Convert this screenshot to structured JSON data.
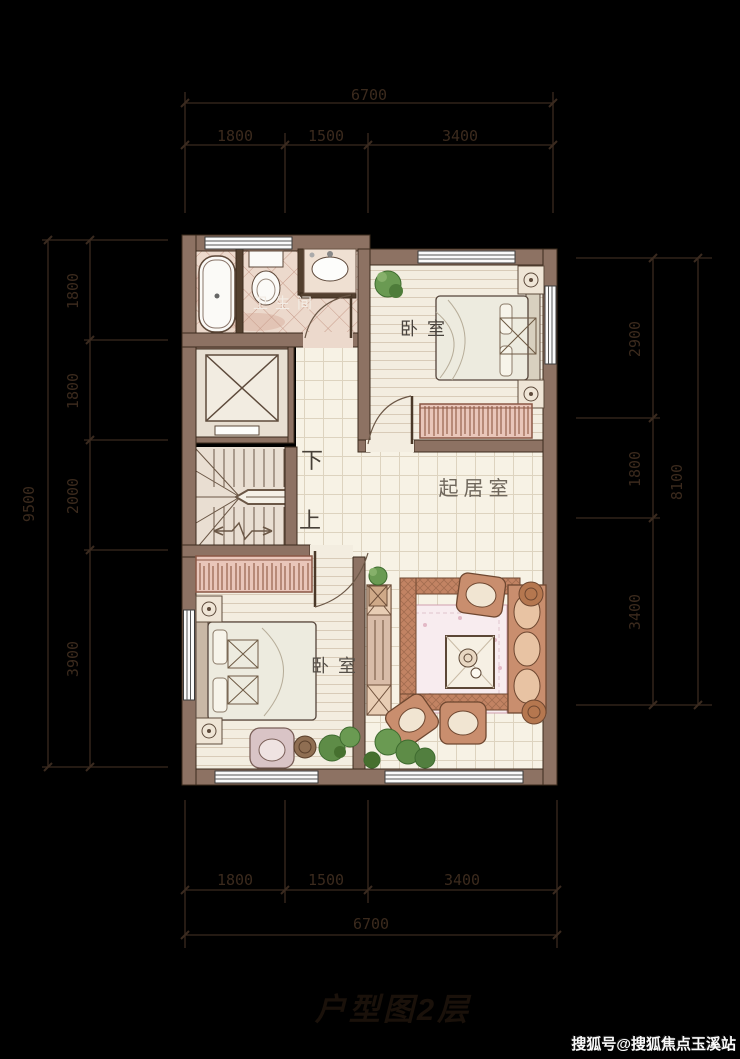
{
  "title": {
    "caption": "户型图2层"
  },
  "watermark": {
    "text": "搜狐号@搜狐焦点玉溪站"
  },
  "rooms": {
    "bathroom": "卫生间",
    "bedroom_top": "卧室",
    "bedroom_bottom": "卧室",
    "living": "起居室",
    "stair_down": "下",
    "stair_up": "上"
  },
  "dimensions": {
    "top": {
      "total": "6700",
      "segments": [
        "1800",
        "1500",
        "3400"
      ]
    },
    "bottom": {
      "total": "6700",
      "segments": [
        "1800",
        "1500",
        "3400"
      ]
    },
    "left": {
      "total": "9500",
      "segments": [
        "1800",
        "1800",
        "2000",
        "3900"
      ]
    },
    "right": {
      "total": "8100",
      "segments": [
        "2900",
        "1800",
        "3400"
      ]
    }
  },
  "colors": {
    "background": "#000000",
    "wall": "#8d7263",
    "dimension_line": "#3a2a1f",
    "bath_tile": "#ecd9cc",
    "wood_floor": "#f3ede0",
    "living_tile": "#f7f2e5",
    "sofa": "#c28363",
    "rug": "#f8ecef",
    "plant": "#6a9a52",
    "watermark_text": "#fafafa"
  }
}
